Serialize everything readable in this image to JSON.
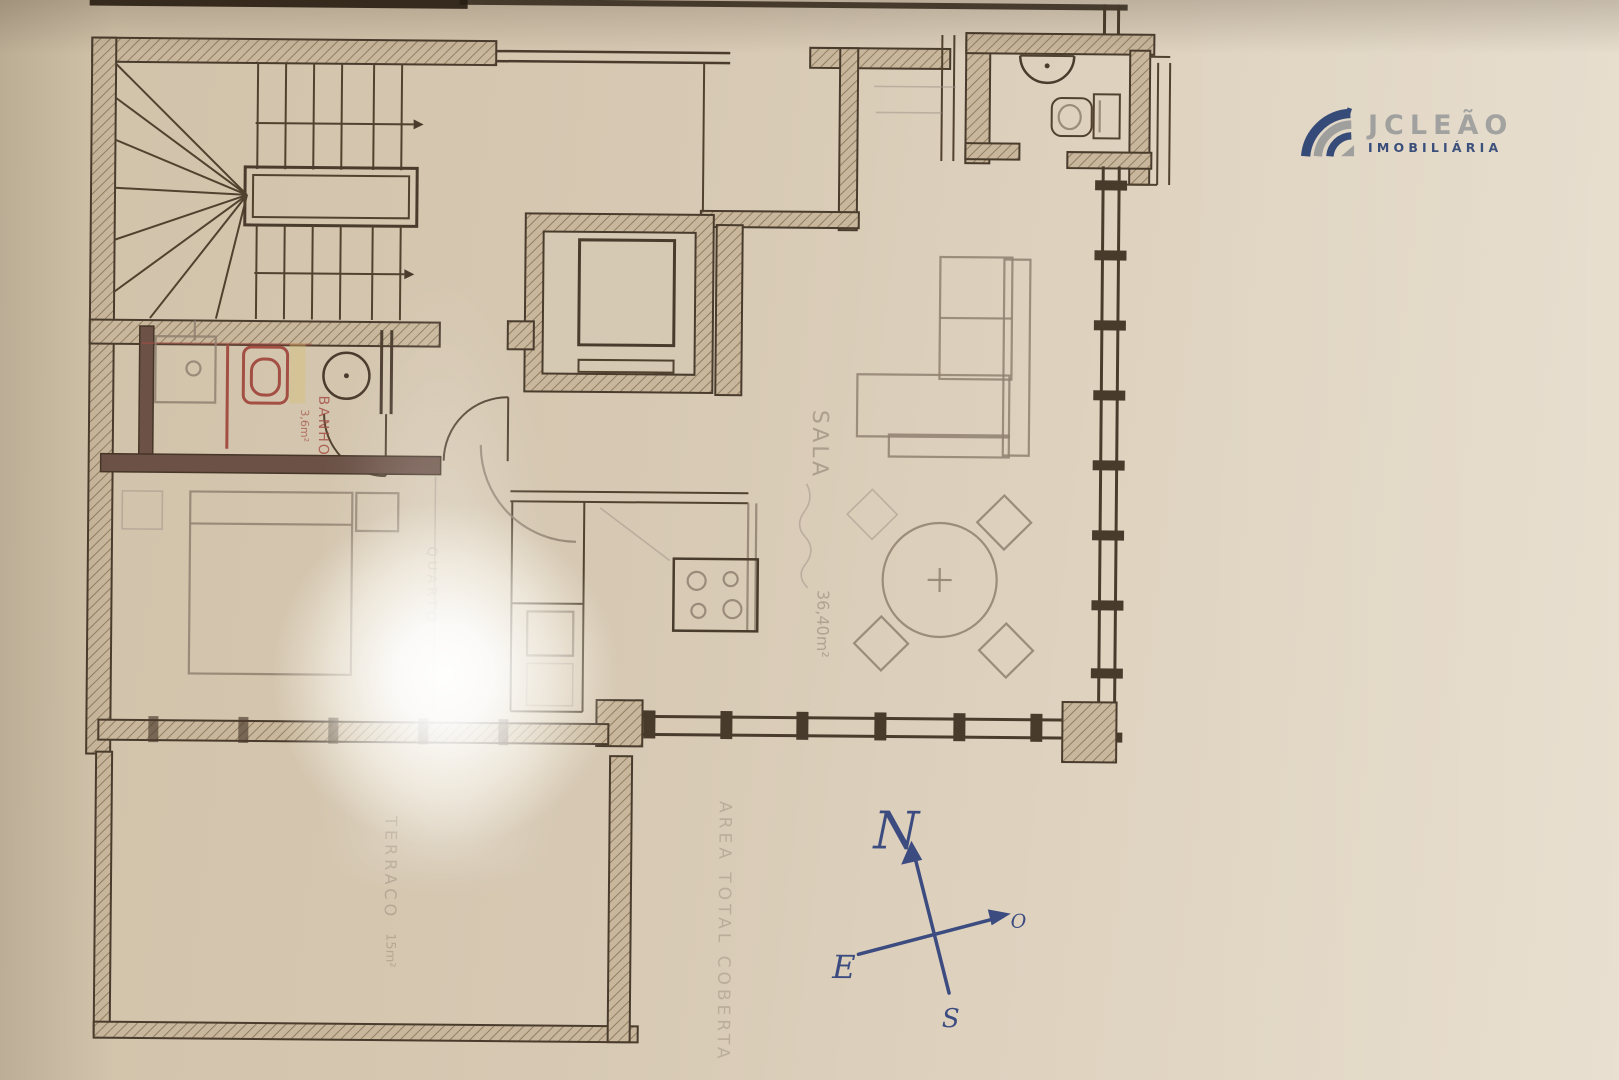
{
  "logo": {
    "name": "JCLEÃO",
    "subtitle": "IMOBILIÁRIA",
    "brand_navy": "#2e4473",
    "brand_gray": "#9b9b99"
  },
  "plan": {
    "labels": {
      "bath": "BANHO",
      "bath_area": "3,6m²",
      "bedroom": "QUARTO",
      "living": "SALA",
      "living_area": "36,40m²",
      "terrace": "TERRACO",
      "terrace_area": "15m²",
      "total_area": "AREA TOTAL COBERTA"
    },
    "compass": {
      "north": "N",
      "south": "S",
      "east": "E",
      "west": "O"
    }
  },
  "colors": {
    "paper": "#d9ccb8",
    "ink": "#4a3c2d",
    "pencil": "#8f8070",
    "fixture_red": "#a34f44",
    "pen_blue": "#3c4c80"
  }
}
